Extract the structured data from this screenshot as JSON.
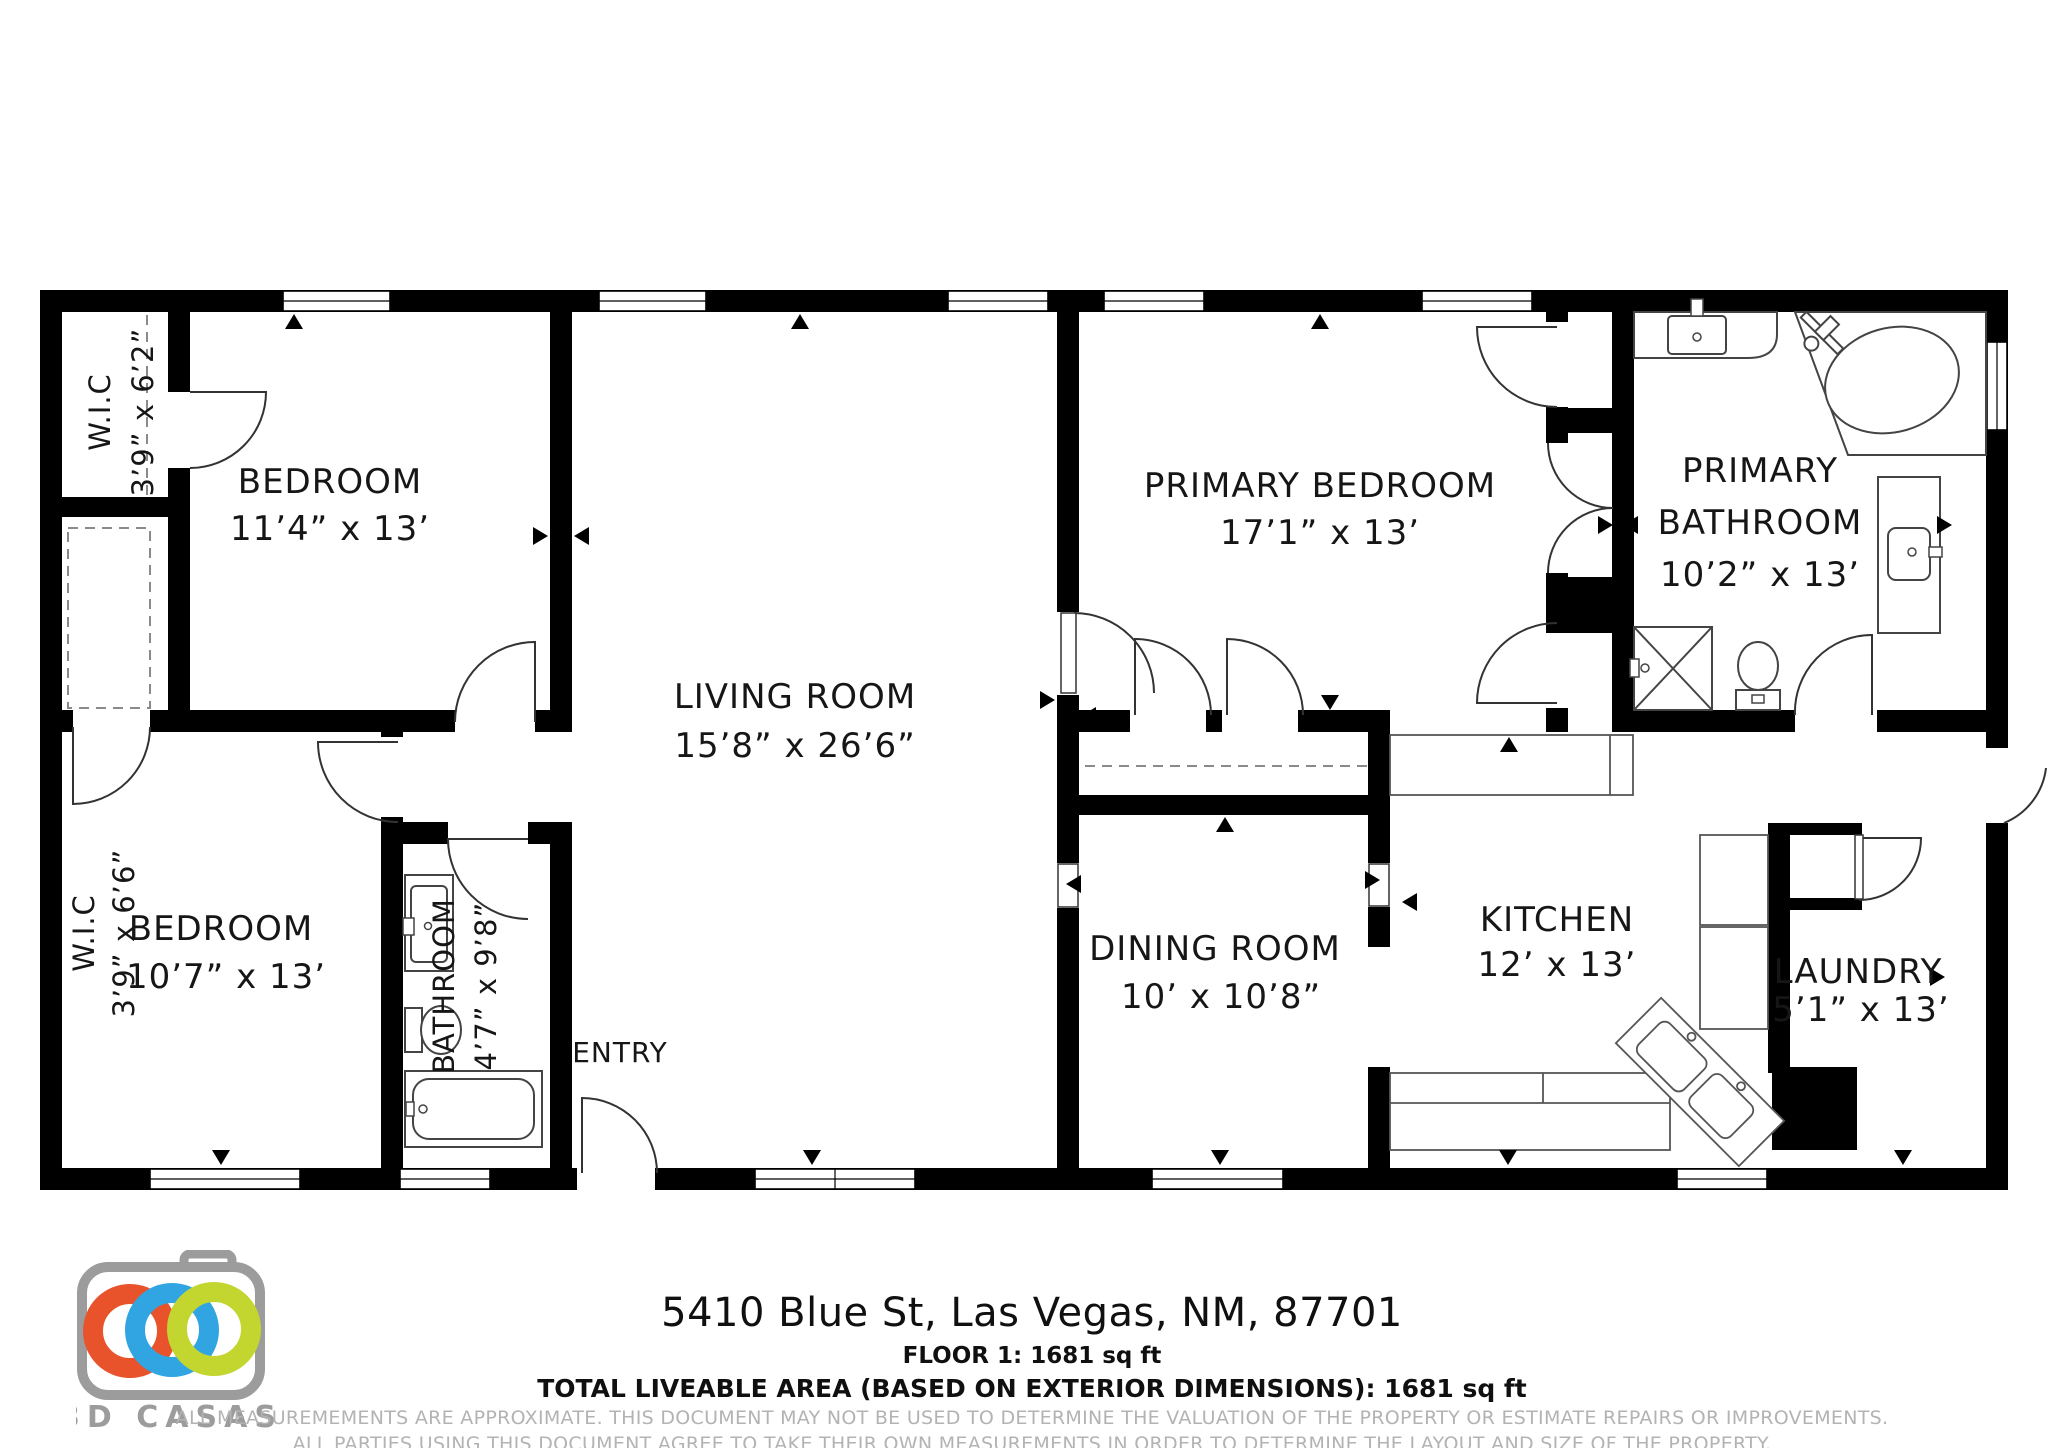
{
  "plan": {
    "rooms": {
      "wic_top": {
        "line1": "W.I.C",
        "line2": "3’9” x 6’2”"
      },
      "bedroom_top": {
        "line1": "BEDROOM",
        "line2": "11’4” x 13’"
      },
      "wic_bottom": {
        "line1": "W.I.C",
        "line2": "3’9” x 6’6”"
      },
      "bedroom_bottom": {
        "line1": "BEDROOM",
        "line2": "10’7” x 13’"
      },
      "bathroom": {
        "line1": "BATHROOM",
        "line2": "4’7” x 9’8”"
      },
      "entry": {
        "line1": "ENTRY"
      },
      "living_room": {
        "line1": "LIVING ROOM",
        "line2": "15’8” x 26’6”"
      },
      "primary_bedroom": {
        "line1": "PRIMARY BEDROOM",
        "line2": "17’1” x 13’"
      },
      "primary_bathroom": {
        "line1": "PRIMARY",
        "line2": "BATHROOM",
        "line3": "10’2” x 13’"
      },
      "dining_room": {
        "line1": "DINING ROOM",
        "line2": "10’ x 10’8”"
      },
      "kitchen": {
        "line1": "KITCHEN",
        "line2": "12’ x 13’"
      },
      "laundry": {
        "line1": "LAUNDRY",
        "line2": "5’1” x 13’"
      }
    }
  },
  "footer": {
    "address": "5410 Blue St, Las Vegas, NM, 87701",
    "floor_line": "FLOOR 1: 1681 sq ft",
    "total_line": "TOTAL LIVEABLE AREA (BASED ON EXTERIOR DIMENSIONS): 1681 sq ft",
    "disclaimer_line1": "ALL MEASUREMEMENTS ARE APPROXIMATE. THIS DOCUMENT MAY NOT BE USED TO DETERMINE THE VALUATION OF THE PROPERTY OR ESTIMATE REPAIRS OR IMPROVEMENTS.",
    "disclaimer_line2": "ALL PARTIES USING THIS DOCUMENT AGREE TO TAKE THEIR OWN MEASUREMENTS IN ORDER TO DETERMINE THE LAYOUT AND SIZE OF THE PROPERTY."
  },
  "logo": {
    "brand": "3D CASAS",
    "camera_color": "#9c9c9c",
    "ring_colors": [
      "#e8532c",
      "#31a5e1",
      "#c3d630"
    ]
  }
}
